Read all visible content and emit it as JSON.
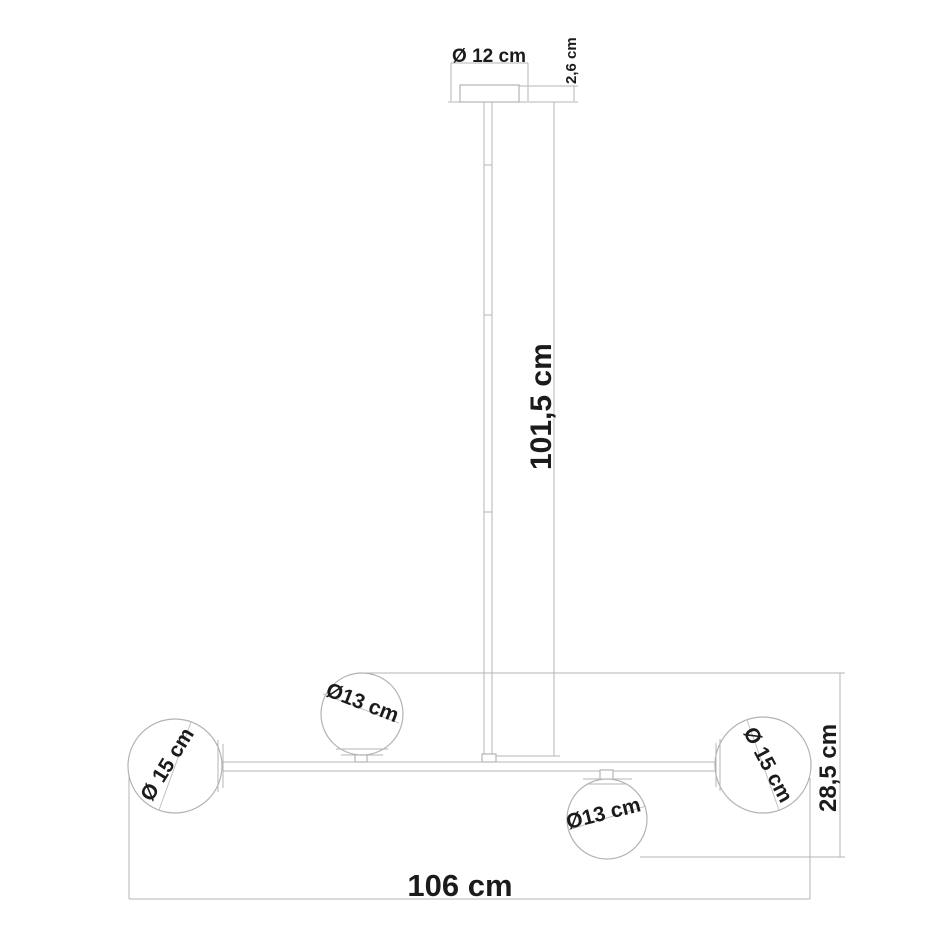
{
  "diagram": {
    "type": "pendant-lamp-technical-drawing",
    "background_color": "#ffffff",
    "line_color": "#b6b6b6",
    "text_color": "#1b1b1b"
  },
  "labels": {
    "canopy_diameter": "Ø 12 cm",
    "canopy_height": "2,6 cm",
    "rod_height": "101,5 cm",
    "fixture_height": "28,5 cm",
    "total_width": "106 cm",
    "globe_top": "Ø13 cm",
    "globe_bottom": "Ø13 cm",
    "globe_left": "Ø 15 cm",
    "globe_right": "Ø 15 cm"
  }
}
